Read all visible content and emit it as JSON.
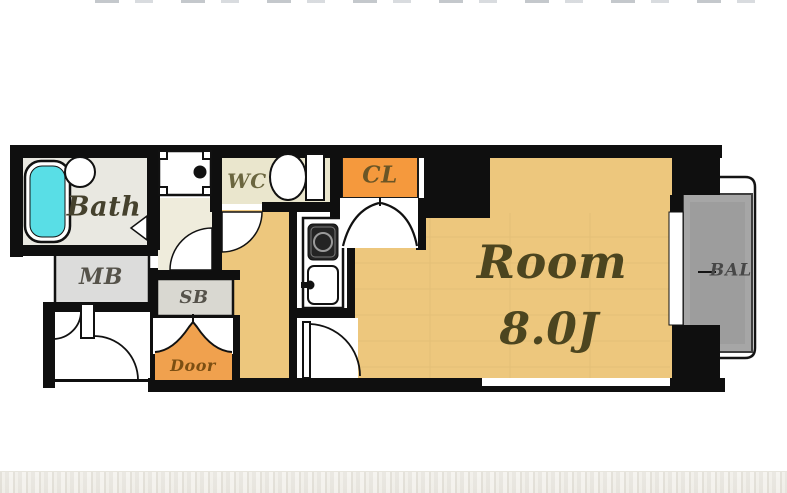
{
  "plan": {
    "labels": {
      "bath": "Bath",
      "meter_box": "MB",
      "wc": "WC",
      "closet": "CL",
      "shoe_box": "SB",
      "entrance": "Door",
      "room_name": "Room",
      "room_size": "8.0J",
      "balcony": "BAL"
    },
    "colors": {
      "wall": "#0f0f0f",
      "room_floor": "#edc77d",
      "closet_orange": "#f5993d",
      "entrance_orange": "#f0a14e",
      "bath_floor": "#e9e8e1",
      "washroom_floor": "#efecdc",
      "wc_floor": "#eae6cd",
      "meter_box_gray": "#dcdcdb",
      "shoe_box_gray": "#d9d8d1",
      "balcony_gray": "#a6a6a6",
      "bathtub_cyan": "#59dee6"
    }
  }
}
